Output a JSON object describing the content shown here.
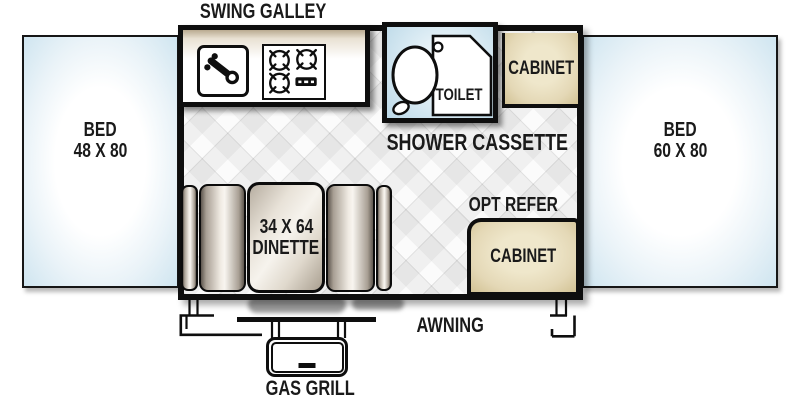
{
  "labels": {
    "swing_galley": "SWING GALLEY",
    "shower_cassette": "SHOWER CASSETTE",
    "toilet": "TOILET",
    "cabinet_top": "CABINET",
    "cabinet_bottom": "CABINET",
    "opt_refer": "OPT REFER",
    "awning": "AWNING",
    "gas_grill": "GAS GRILL"
  },
  "beds": {
    "left": {
      "name": "BED",
      "size": "48 X 80"
    },
    "right": {
      "name": "BED",
      "size": "60 X 80"
    }
  },
  "dinette": {
    "size": "34 X 64",
    "name": "DINETTE"
  },
  "colors": {
    "outline": "#0e0e0e",
    "bed_fill": "#d4e7f2",
    "shower_fill": "#c9e2ee",
    "cabinet_fill": "#e6dcba",
    "label_text": "#1a1a1a"
  }
}
